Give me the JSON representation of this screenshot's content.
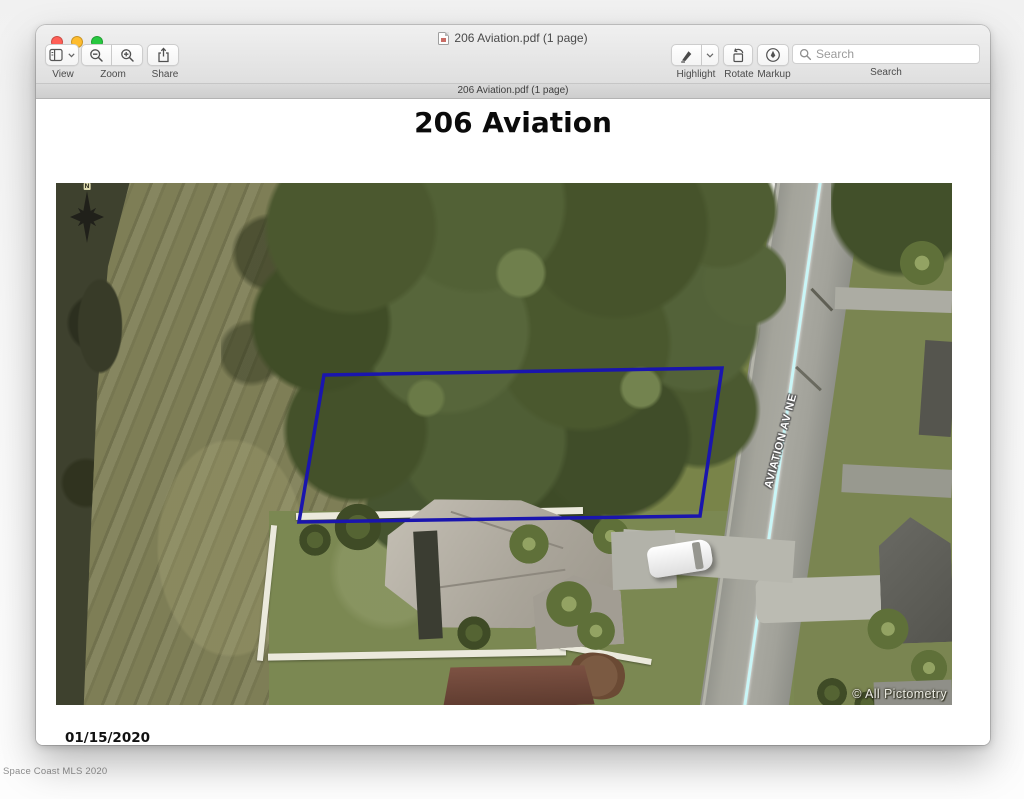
{
  "window": {
    "title": "206 Aviation.pdf (1 page)",
    "doc_bar_title": "206 Aviation.pdf (1 page)",
    "toolbar": {
      "view": "View",
      "zoom": "Zoom",
      "share": "Share",
      "highlight": "Highlight",
      "rotate": "Rotate",
      "markup": "Markup",
      "search": "Search",
      "search_placeholder": "Search"
    }
  },
  "document": {
    "title": "206 Aviation",
    "date": "01/15/2020",
    "map": {
      "street": "AVIATION AV NE",
      "credit": "© All Pictometry",
      "compass_north": "N"
    }
  },
  "desktop": {
    "watermark": "Space Coast MLS 2020"
  },
  "colors": {
    "lot_outline": "#1a15ae",
    "road_centerline": "#c9f6f7",
    "traffic_close": "#ff5f57",
    "traffic_minimize": "#febc2e",
    "traffic_zoom": "#28c840"
  }
}
